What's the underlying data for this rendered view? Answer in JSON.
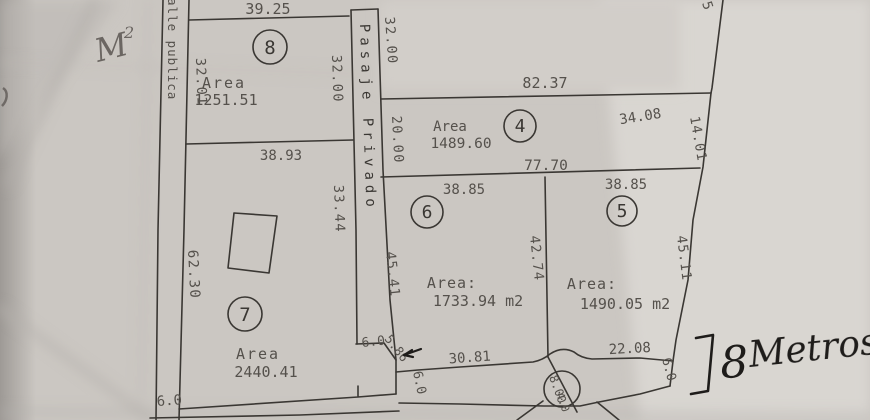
{
  "colors": {
    "paper": "#cbc7c2",
    "paper_light": "#d8d5d0",
    "ink": "#3a3733",
    "dim_text": "#55514c",
    "pencil": "#6b6662",
    "pen": "#1e1c1a"
  },
  "handwritten": {
    "m_note": "M",
    "m_note_exp": "2",
    "width_number": "8",
    "width_word": "Metros"
  },
  "streets": {
    "left": "alle publica",
    "middle": "Pasaje Privado",
    "bottom_width": "6.0"
  },
  "strip": {
    "right_top_dim": "32.00"
  },
  "boundary": {
    "top_right_partial": "5"
  },
  "parcels": {
    "p8": {
      "id": "8",
      "area_label": "Area",
      "area": "1251.51",
      "top": "39.25",
      "left": "32.01",
      "right": "32.00",
      "bottom": "38.93"
    },
    "p7": {
      "id": "7",
      "area_label": "Area",
      "area": "2440.41",
      "left": "62.30",
      "right": "33.44",
      "chamfer_a": "6.0",
      "chamfer_b": "5.86"
    },
    "p4": {
      "id": "4",
      "area_label": "Area",
      "area": "1489.60",
      "top": "82.37",
      "left": "20.00",
      "top_right": "34.08",
      "right": "14.01",
      "bottom": "77.70"
    },
    "p6": {
      "id": "6",
      "area_label": "Area:",
      "area": "1733.94 m2",
      "top": "38.85",
      "left": "45.41",
      "right": "42.74"
    },
    "p5": {
      "id": "5",
      "area_label": "Area:",
      "area": "1490.05 m2",
      "top": "38.85",
      "right": "45.11"
    }
  },
  "road": {
    "seg_left": "30.81",
    "seg_right": "22.08",
    "width_left": "6.0",
    "width_right": "6.0",
    "well_a": "8.00",
    "well_b": "4.0"
  }
}
